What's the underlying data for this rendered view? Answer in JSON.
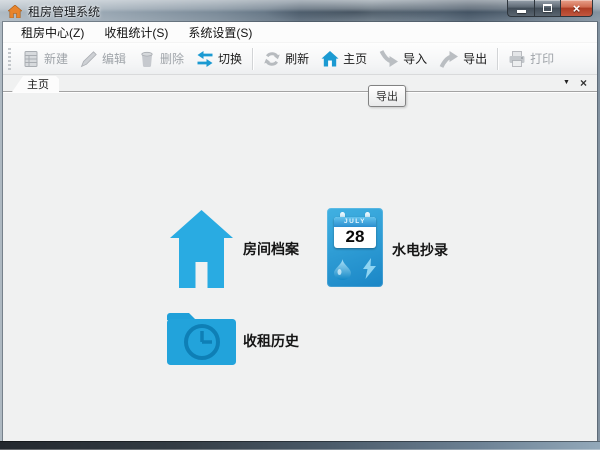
{
  "window": {
    "title": "租房管理系统",
    "close_glyph": "×"
  },
  "menu": {
    "items": [
      "租房中心(Z)",
      "收租统计(S)",
      "系统设置(S)"
    ]
  },
  "toolbar": {
    "buttons": [
      {
        "label": "新建",
        "enabled": false
      },
      {
        "label": "编辑",
        "enabled": false
      },
      {
        "label": "删除",
        "enabled": false
      },
      {
        "label": "切换",
        "enabled": true
      },
      {
        "label": "刷新",
        "enabled": true
      },
      {
        "label": "主页",
        "enabled": true
      },
      {
        "label": "导入",
        "enabled": true
      },
      {
        "label": "导出",
        "enabled": true
      },
      {
        "label": "打印",
        "enabled": false
      }
    ]
  },
  "tabstrip": {
    "active_tab": "主页",
    "list_glyph": "▼",
    "close_glyph": "×"
  },
  "tooltip": {
    "text": "导出"
  },
  "content": {
    "shortcuts": [
      {
        "label": "房间档案",
        "icon": "house-icon"
      },
      {
        "label": "水电抄录",
        "icon": "calendar-utilities-icon",
        "calendar_month": "JULY",
        "calendar_day": "28"
      },
      {
        "label": "收租历史",
        "icon": "folder-clock-icon"
      }
    ]
  },
  "colors": {
    "shortcut_blue": "#29ABE2",
    "toolbar_icon_blue": "#1B9AD2",
    "title_house_orange": "#E8842C",
    "close_button_red": "#C2573F",
    "disabled_text": "#9FA4A9"
  }
}
